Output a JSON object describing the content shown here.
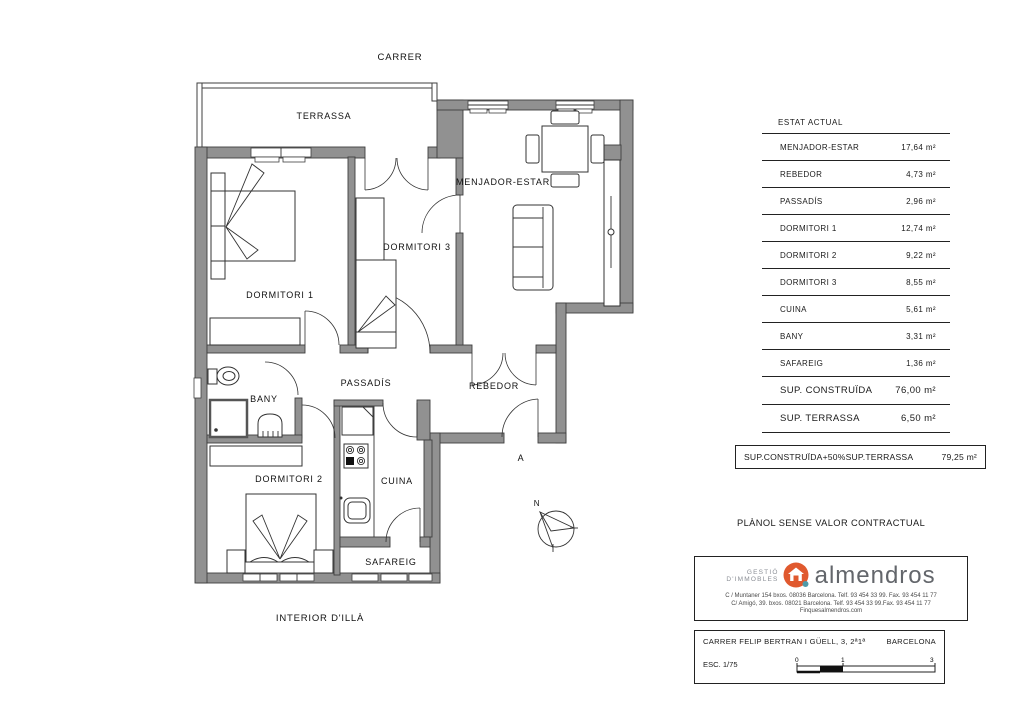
{
  "plan": {
    "street_label": "CARRER",
    "bottom_label": "INTERIOR D'ILLÀ",
    "compass_label": "N",
    "entrance_marker": "A",
    "rooms": {
      "terrassa": "TERRASSA",
      "menjador": "MENJADOR-ESTAR",
      "dormitori3": "DORMITORI 3",
      "dormitori1": "DORMITORI 1",
      "passadis": "PASSADÍS",
      "rebedor": "REBEDOR",
      "bany": "BANY",
      "dormitori2": "DORMITORI 2",
      "cuina": "CUINA",
      "safareig": "SAFAREIG"
    }
  },
  "surface_table": {
    "title": "ESTAT ACTUAL",
    "rows": [
      {
        "label": "MENJADOR-ESTAR",
        "value": "17,64 m²"
      },
      {
        "label": "REBEDOR",
        "value": "4,73 m²"
      },
      {
        "label": "PASSADÍS",
        "value": "2,96 m²"
      },
      {
        "label": "DORMITORI 1",
        "value": "12,74 m²"
      },
      {
        "label": "DORMITORI 2",
        "value": "9,22 m²"
      },
      {
        "label": "DORMITORI 3",
        "value": "8,55 m²"
      },
      {
        "label": "CUINA",
        "value": "5,61 m²"
      },
      {
        "label": "BANY",
        "value": "3,31 m²"
      },
      {
        "label": "SAFAREIG",
        "value": "1,36 m²"
      }
    ],
    "summary_rows": [
      {
        "label": "SUP. CONSTRUÏDA",
        "value": "76,00 m²"
      },
      {
        "label": "SUP. TERRASSA",
        "value": "6,50 m²"
      }
    ],
    "total_box": {
      "label": "SUP.CONSTRUÏDA+50%SUP.TERRASSA",
      "value": "79,25 m²"
    }
  },
  "disclaimer": "PLÀNOL SENSE VALOR CONTRACTUAL",
  "agency": {
    "tagline_line1": "GESTIÓ",
    "tagline_line2": "D'IMMOBLES",
    "name": "almendros",
    "address_line1": "C / Muntaner 154 bxos. 08036 Barcelona. Telf. 93 454 33 99. Fax. 93 454 11 77",
    "address_line2": "C/ Amigó, 39. bxos. 08021 Barcelona. Telf. 93 454 33 99.Fax. 93 454 11 77",
    "website": "Finquesalmendros.com",
    "brand_orange": "#e0592e",
    "brand_teal": "#4f9aa8",
    "brand_gray": "#63666b"
  },
  "project": {
    "address": "CARRER FELIP BERTRAN I GÜELL, 3, 2ª1ª",
    "city": "BARCELONA",
    "scale_label": "ESC. 1/75",
    "scale_tick_0": "0",
    "scale_tick_1": "1",
    "scale_tick_3": "3"
  }
}
